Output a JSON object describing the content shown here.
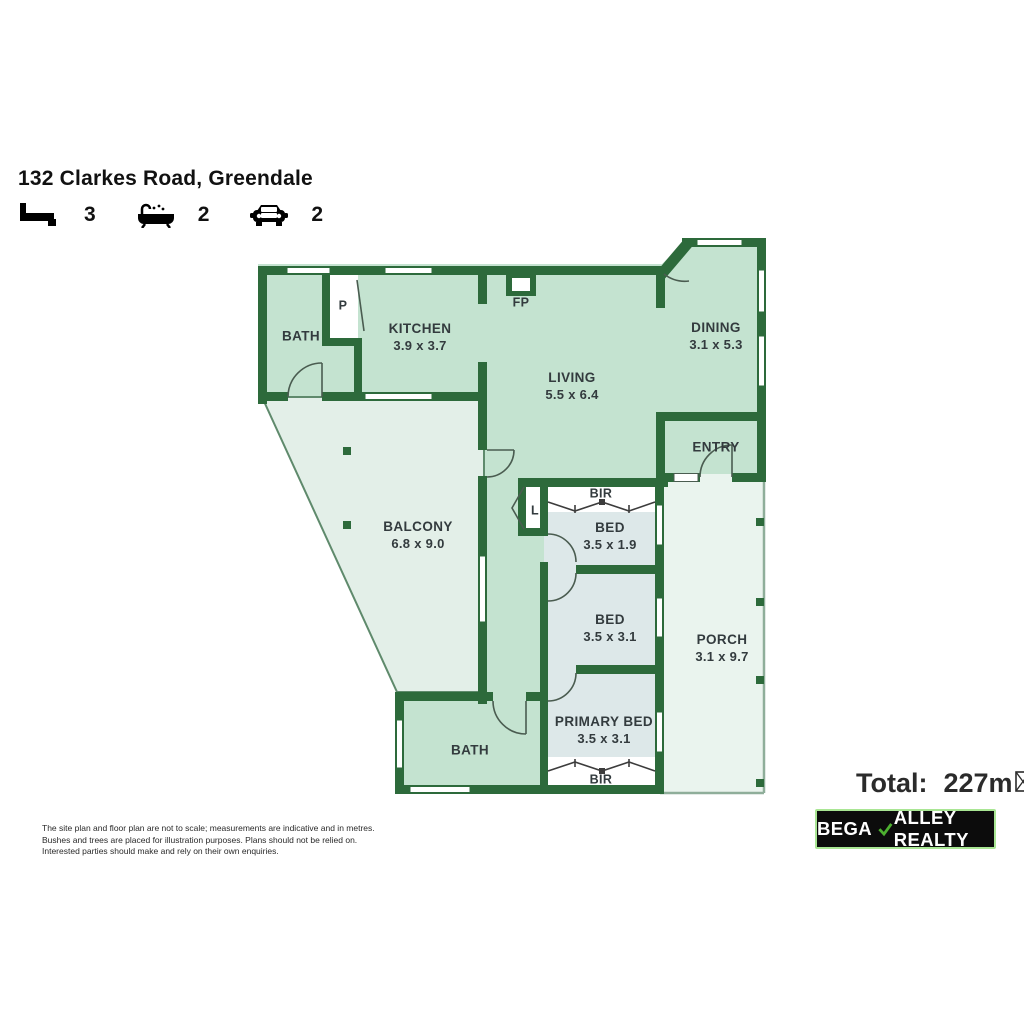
{
  "header": {
    "title": "132 Clarkes Road, Greendale",
    "features": [
      {
        "icon": "bed-icon",
        "count": "3"
      },
      {
        "icon": "bath-icon",
        "count": "2"
      },
      {
        "icon": "car-icon",
        "count": "2"
      }
    ]
  },
  "floorplan": {
    "rooms": {
      "bath_top": {
        "name": "BATH",
        "dims": ""
      },
      "kitchen": {
        "name": "KITCHEN",
        "dims": "3.9 x 3.7"
      },
      "living": {
        "name": "LIVING",
        "dims": "5.5 x 6.4"
      },
      "dining": {
        "name": "DINING",
        "dims": "3.1 x 5.3"
      },
      "entry": {
        "name": "ENTRY",
        "dims": ""
      },
      "balcony": {
        "name": "BALCONY",
        "dims": "6.8 x 9.0"
      },
      "bed_1": {
        "name": "BED",
        "dims": "3.5 x 1.9"
      },
      "bed_2": {
        "name": "BED",
        "dims": "3.5 x 3.1"
      },
      "primary_bed": {
        "name": "PRIMARY BED",
        "dims": "3.5 x 3.1"
      },
      "bath_bottom": {
        "name": "BATH",
        "dims": ""
      },
      "porch": {
        "name": "PORCH",
        "dims": "3.1 x 9.7"
      }
    },
    "markers": {
      "fireplace": "FP",
      "pantry": "P",
      "linen": "L",
      "built_in_robe_1": "BIR",
      "built_in_robe_2": "BIR"
    },
    "colors": {
      "wall": "#2d6a3b",
      "room_fill": "#c4e3d0",
      "bedroom_fill": "#dde8e9",
      "balcony_fill": "#e3efe8",
      "porch_fill": "#eaf4ee"
    }
  },
  "summary": {
    "total_label": "Total:",
    "total_value": "227m"
  },
  "brand": {
    "name_prefix": "BEGA",
    "name_suffix": "ALLEY REALTY",
    "check_color": "#4db030",
    "border_color": "#a9e694"
  },
  "disclaimer": {
    "lines": [
      "The site plan and floor plan are not to scale; measurements are indicative and in metres.",
      "Bushes and trees are placed for illustration purposes. Plans should not be relied on.",
      "Interested parties should make and rely on their own enquiries."
    ]
  }
}
